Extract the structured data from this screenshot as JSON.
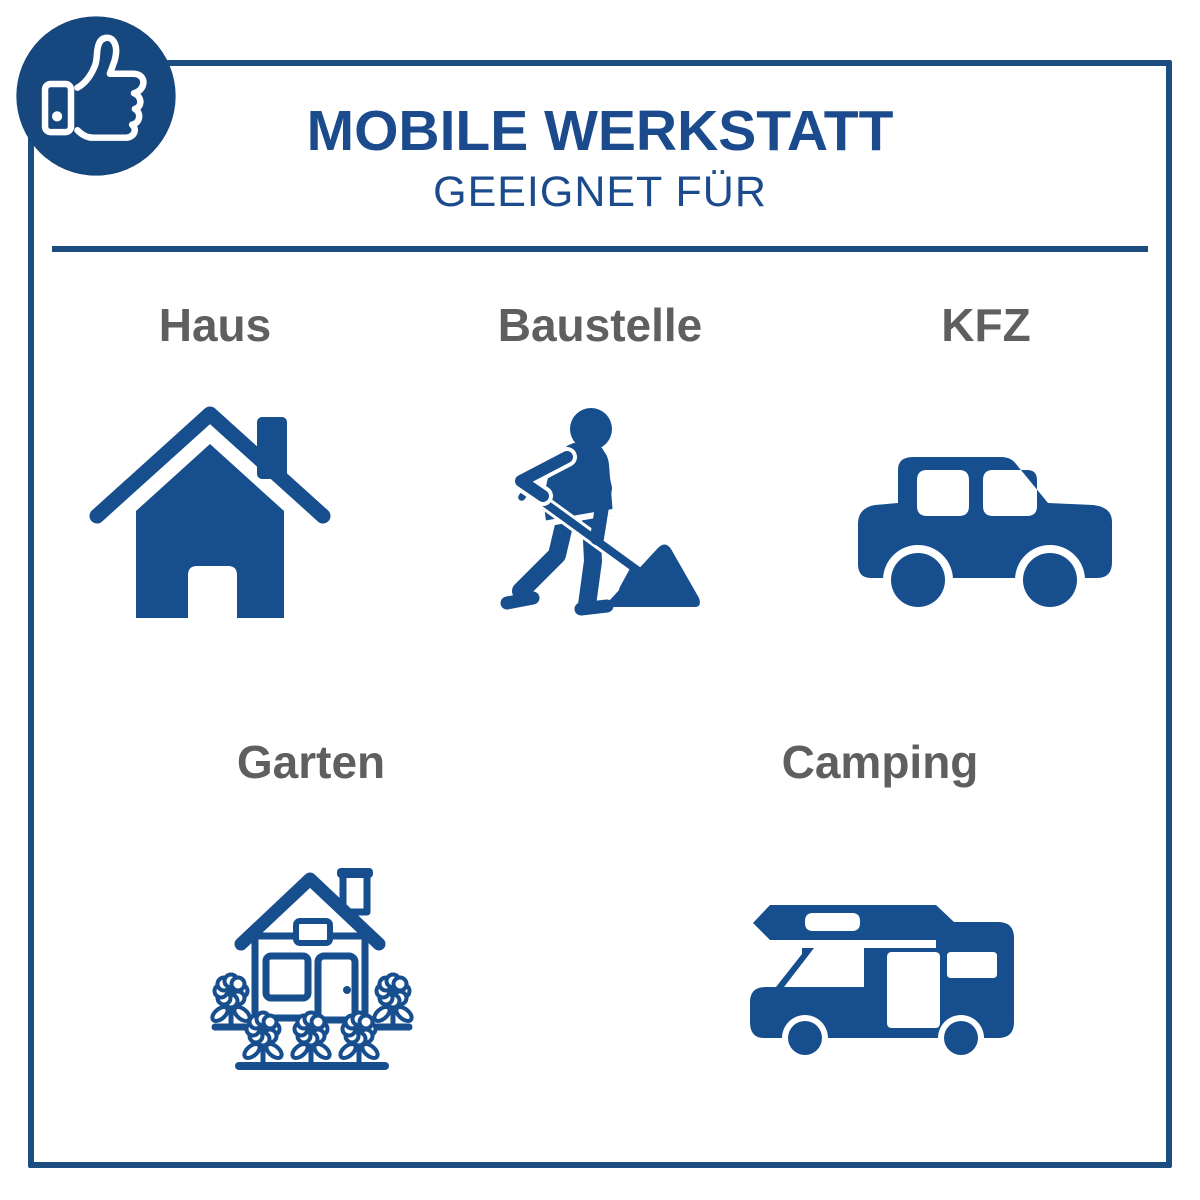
{
  "header": {
    "title": "MOBILE WERKSTATT",
    "subtitle": "GEEIGNET FÜR"
  },
  "badge": {
    "icon": "thumbs-up-phone-icon"
  },
  "items": [
    {
      "label": "Haus",
      "icon": "house-icon"
    },
    {
      "label": "Baustelle",
      "icon": "construction-worker-icon"
    },
    {
      "label": "KFZ",
      "icon": "car-icon"
    },
    {
      "label": "Garten",
      "icon": "garden-house-icon"
    },
    {
      "label": "Camping",
      "icon": "camper-van-icon"
    }
  ],
  "colors": {
    "icon_blue": "#164e8e",
    "title_blue": "#1b4b8c",
    "frame_blue": "#1c4c80",
    "badge_blue": "#17477f",
    "label_gray": "#5f5f5f"
  }
}
